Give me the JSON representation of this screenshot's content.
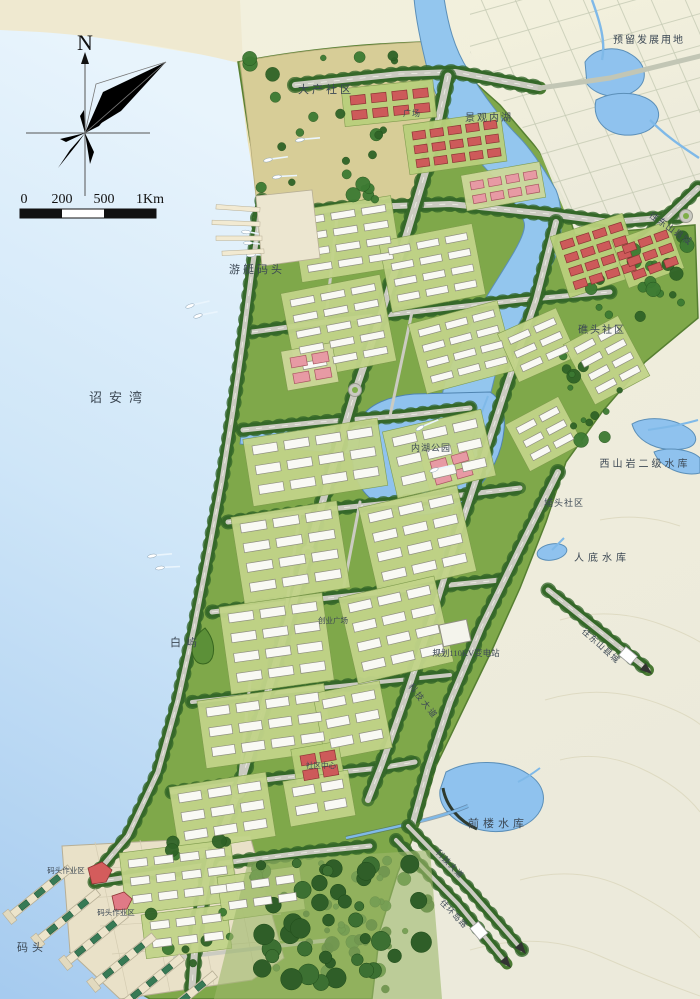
{
  "map": {
    "compass": {
      "north": "N"
    },
    "scale": {
      "ticks": [
        "0",
        "200",
        "500",
        "1Km"
      ]
    },
    "colors": {
      "sea_light": "#e8f4fc",
      "sea_deep": "#a6cbef",
      "land": "#efeedb",
      "band_green": "#7fa84a",
      "road": "#cbcbc1",
      "tree": "#2f6327",
      "water": "#8fc2ee",
      "roof_red": "#cd5a5a",
      "building": "#f9f9f4",
      "tan": "#d7cd97",
      "sand": "#ecdfb0"
    },
    "region_labels": [
      {
        "id": "label-dachan-community",
        "text": "大产社区",
        "x": 326,
        "y": 93,
        "size": 11,
        "ls": 3,
        "rot": 0,
        "color": "#3c4854"
      },
      {
        "id": "label-plaza-north",
        "text": "广场",
        "x": 412,
        "y": 116,
        "size": 8,
        "ls": 1,
        "rot": 0,
        "color": "#55605a"
      },
      {
        "id": "label-scenic-inner-lake",
        "text": "景观内湖",
        "x": 489,
        "y": 121,
        "size": 10,
        "ls": 2,
        "rot": 0,
        "color": "#3f5d75"
      },
      {
        "id": "label-reserved-land",
        "text": "预留发展用地",
        "x": 649,
        "y": 43,
        "size": 10,
        "ls": 2,
        "rot": 0,
        "color": "#9aa08d"
      },
      {
        "id": "label-to-dongshan-north",
        "text": "往东山县城",
        "x": 669,
        "y": 231,
        "size": 9,
        "ls": 1,
        "rot": 35,
        "color": "#4a5568"
      },
      {
        "id": "label-yacht-marina",
        "text": "游艇码头",
        "x": 257,
        "y": 273,
        "size": 11,
        "ls": 3,
        "rot": 0,
        "color": "#3c4854"
      },
      {
        "id": "label-jiaotou-community",
        "text": "礁头社区",
        "x": 602,
        "y": 333,
        "size": 10,
        "ls": 2,
        "rot": 0,
        "color": "#6f7c5f"
      },
      {
        "id": "label-zhaoan-bay",
        "text": "诏安湾",
        "x": 119,
        "y": 402,
        "size": 13,
        "ls": 7,
        "rot": 0,
        "color": "#2e4a5c"
      },
      {
        "id": "label-inner-lake-park",
        "text": "内湖公园",
        "x": 431,
        "y": 451,
        "size": 9,
        "ls": 1,
        "rot": 0,
        "color": "#33566e"
      },
      {
        "id": "label-xishanyan-reservoir",
        "text": "西山岩二级水库",
        "x": 645,
        "y": 467,
        "size": 10,
        "ls": 3,
        "rot": 0,
        "color": "#41607a"
      },
      {
        "id": "label-putou-community",
        "text": "埔头社区",
        "x": 564,
        "y": 506,
        "size": 9,
        "ls": 1,
        "rot": 0,
        "color": "#6f7c5f"
      },
      {
        "id": "label-rendi-reservoir",
        "text": "人底水库",
        "x": 602,
        "y": 561,
        "size": 10,
        "ls": 4,
        "rot": 0,
        "color": "#41607a"
      },
      {
        "id": "label-baiyu-island",
        "text": "白屿",
        "x": 186,
        "y": 646,
        "size": 11,
        "ls": 5,
        "rot": 0,
        "color": "#2e4a5c"
      },
      {
        "id": "label-chuangye-plaza",
        "text": "创业广场",
        "x": 333,
        "y": 623,
        "size": 7.5,
        "ls": 0,
        "rot": 0,
        "color": "#4a5568"
      },
      {
        "id": "label-substation",
        "text": "规划110KV变电站",
        "x": 466,
        "y": 656,
        "size": 8.5,
        "ls": 0,
        "rot": 0,
        "color": "#4a5568"
      },
      {
        "id": "label-keji-avenue-north",
        "text": "科技大道",
        "x": 421,
        "y": 703,
        "size": 8.5,
        "ls": 2,
        "rot": 52,
        "color": "#4a5568"
      },
      {
        "id": "label-to-dongshan-south",
        "text": "往东山县城",
        "x": 599,
        "y": 648,
        "size": 8.5,
        "ls": 1,
        "rot": 42,
        "color": "#4a5568"
      },
      {
        "id": "label-qianlou-reservoir",
        "text": "前楼水库",
        "x": 498,
        "y": 827,
        "size": 11,
        "ls": 4,
        "rot": 0,
        "color": "#41607a"
      },
      {
        "id": "label-keji-avenue-south",
        "text": "科技大道",
        "x": 448,
        "y": 866,
        "size": 8,
        "ls": 1,
        "rot": 46,
        "color": "#4a5568"
      },
      {
        "id": "label-ring-road",
        "text": "往环岛路",
        "x": 452,
        "y": 916,
        "size": 8,
        "ls": 1,
        "rot": 46,
        "color": "#4a5568"
      },
      {
        "id": "label-wharf",
        "text": "码头",
        "x": 32,
        "y": 951,
        "size": 11,
        "ls": 4,
        "rot": 0,
        "color": "#2e4a5c"
      },
      {
        "id": "label-wharf-area-1",
        "text": "码头作业区",
        "x": 66,
        "y": 873,
        "size": 7.5,
        "ls": 0,
        "rot": 0,
        "color": "#4a5568"
      },
      {
        "id": "label-wharf-area-2",
        "text": "码头作业区",
        "x": 116,
        "y": 915,
        "size": 7.5,
        "ls": 0,
        "rot": 0,
        "color": "#4a5568"
      },
      {
        "id": "label-community-center",
        "text": "社区中心",
        "x": 321,
        "y": 768,
        "size": 7.5,
        "ls": 0,
        "rot": 0,
        "color": "#4a5568"
      }
    ]
  }
}
